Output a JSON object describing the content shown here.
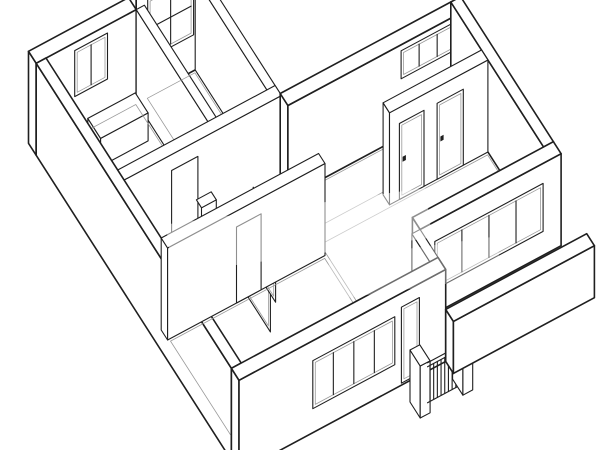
{
  "meta": {
    "description": "Black and white axonometric cutaway line drawing of an apartment floor plan with rooms, windows, interior doors and a balcony with railing",
    "drawing_type": "axonometric-floor-plan"
  },
  "colors": {
    "background": "#ffffff",
    "line": "#1f1f1f",
    "line_light": "#9a9a9a",
    "fill": "#ffffff"
  },
  "drawing": {
    "canvas": {
      "width": 600,
      "height": 450
    },
    "projection": {
      "origin": [
        46,
        150
      ],
      "u_axis": [
        0.82,
        -0.44
      ],
      "v_axis": [
        0.64,
        1.0
      ]
    },
    "elements": [
      {
        "kind": "box",
        "id": "wall-top-center-tall",
        "u1": 110,
        "u2": 192,
        "v1": -12,
        "v2": 0,
        "h": 152,
        "w": "heavy",
        "openings": [
          {
            "type": "window",
            "from": 124,
            "to": 180,
            "sill": 36,
            "head": 96,
            "cols": 2,
            "rows": 2
          }
        ]
      },
      {
        "kind": "box",
        "id": "wall-bath-exterior",
        "u1": -12,
        "u2": 110,
        "v1": -12,
        "v2": 0,
        "h": 92,
        "w": "heavy",
        "openings": [
          {
            "type": "window",
            "from": 35,
            "to": 75,
            "sill": 38,
            "head": 84,
            "cols": 2,
            "rows": 1
          }
        ]
      },
      {
        "kind": "box",
        "id": "wall-bath-divider",
        "u1": 110,
        "u2": 120,
        "v1": 0,
        "v2": 120,
        "h": 92,
        "w": "norm"
      },
      {
        "kind": "box",
        "id": "bathtub",
        "u1": 40,
        "u2": 98,
        "v1": 14,
        "v2": 34,
        "h": 28,
        "w": "norm"
      },
      {
        "kind": "floor",
        "id": "floor-bath",
        "pts": [
          [
            2,
            2
          ],
          [
            108,
            2
          ],
          [
            108,
            110
          ],
          [
            2,
            110
          ]
        ]
      },
      {
        "kind": "box",
        "id": "wall-corridor",
        "u1": 182,
        "u2": 192,
        "v1": 0,
        "v2": 175,
        "h": 92,
        "w": "norm"
      },
      {
        "kind": "floor",
        "id": "floor-hall",
        "pts": [
          [
            122,
            2
          ],
          [
            180,
            2
          ],
          [
            180,
            110
          ],
          [
            122,
            110
          ]
        ]
      },
      {
        "kind": "box",
        "id": "wall-hall-south",
        "u1": 0,
        "u2": 192,
        "v1": 112,
        "v2": 122,
        "h": 92,
        "w": "norm",
        "openings": [
          {
            "type": "doorway",
            "from": 58,
            "to": 90,
            "sill": 0,
            "head": 76
          }
        ]
      },
      {
        "kind": "toilet",
        "id": "toilet",
        "u": 105,
        "v": 140
      },
      {
        "kind": "floor",
        "id": "floor-bedroom",
        "pts": [
          [
            194,
            134
          ],
          [
            398,
            134
          ],
          [
            398,
            166
          ],
          [
            194,
            166
          ]
        ]
      },
      {
        "kind": "box",
        "id": "wall-bedroom-north",
        "u1": 192,
        "u2": 400,
        "v1": 120,
        "v2": 132,
        "h": 92,
        "w": "heavy",
        "openings": [
          {
            "type": "transom",
            "from": 330,
            "to": 396,
            "sill": 58,
            "head": 86,
            "cols": 3,
            "rows": 1
          }
        ]
      },
      {
        "kind": "box",
        "id": "wall-northeast-exterior",
        "u1": 400,
        "u2": 412,
        "v1": 120,
        "v2": 265,
        "h": 92,
        "w": "heavy"
      },
      {
        "kind": "box",
        "id": "wall-bedroom-doors",
        "u1": 280,
        "u2": 400,
        "v1": 168,
        "v2": 178,
        "h": 92,
        "w": "norm",
        "openings": [
          {
            "type": "door",
            "from": 292,
            "to": 322,
            "sill": 0,
            "head": 76
          },
          {
            "type": "door",
            "from": 338,
            "to": 370,
            "sill": 0,
            "head": 76
          }
        ]
      },
      {
        "kind": "floor",
        "id": "floor-living",
        "pts": [
          [
            194,
            180
          ],
          [
            398,
            180
          ],
          [
            398,
            263
          ],
          [
            242,
            263
          ],
          [
            242,
            303
          ],
          [
            194,
            303
          ]
        ]
      },
      {
        "kind": "box",
        "id": "wall-southwest-exterior",
        "u1": -12,
        "u2": 0,
        "v1": 0,
        "v2": 305,
        "h": 92,
        "w": "heavy"
      },
      {
        "kind": "leaf",
        "id": "door-leaf-hall",
        "u": 98,
        "v1": 190,
        "v2": 225,
        "h": 76
      },
      {
        "kind": "leaf",
        "id": "door-leaf-glass",
        "u": 120,
        "v1": 170,
        "v2": 205,
        "h": 80
      },
      {
        "kind": "box",
        "id": "wall-bottomroom-north",
        "u1": 0,
        "u2": 192,
        "v1": 180,
        "v2": 190,
        "h": 92,
        "w": "norm",
        "openings": [
          {
            "type": "doorway",
            "from": 84,
            "to": 114,
            "sill": 0,
            "head": 76
          }
        ]
      },
      {
        "kind": "floor",
        "id": "floor-bottomroom",
        "pts": [
          [
            2,
            192
          ],
          [
            190,
            192
          ],
          [
            190,
            303
          ],
          [
            2,
            303
          ]
        ]
      },
      {
        "kind": "box",
        "id": "wall-living-window",
        "u1": 240,
        "u2": 412,
        "v1": 265,
        "v2": 277,
        "h": 92,
        "w": "heavy",
        "openings": [
          {
            "type": "window",
            "from": 258,
            "to": 390,
            "sill": 24,
            "head": 72,
            "cols": 4,
            "rows": 1
          }
        ]
      },
      {
        "kind": "box",
        "id": "wall-step",
        "u1": 230,
        "u2": 240,
        "v1": 277,
        "v2": 317,
        "h": 92,
        "w": "norm"
      },
      {
        "kind": "box",
        "id": "wall-bottom-window",
        "u1": -12,
        "u2": 240,
        "v1": 305,
        "v2": 317,
        "h": 92,
        "w": "heavy",
        "openings": [
          {
            "type": "window",
            "from": 78,
            "to": 178,
            "sill": 24,
            "head": 72,
            "cols": 4,
            "rows": 1
          },
          {
            "type": "window",
            "from": 186,
            "to": 208,
            "sill": 2,
            "head": 78,
            "cols": 1,
            "rows": 1
          }
        ]
      },
      {
        "kind": "box",
        "id": "balcony-pillar-left",
        "u1": 184,
        "u2": 196,
        "v1": 333,
        "v2": 349,
        "h": 52,
        "w": "norm"
      },
      {
        "kind": "railing",
        "id": "balcony-railing",
        "u1": 196,
        "u2": 238,
        "v": 345,
        "h": 46,
        "bars": 9
      },
      {
        "kind": "box",
        "id": "balcony-pillar-right",
        "u1": 236,
        "u2": 248,
        "v1": 333,
        "v2": 349,
        "h": 52,
        "w": "norm"
      },
      {
        "kind": "box",
        "id": "balcony-parapet",
        "u1": 240,
        "u2": 412,
        "v1": 317,
        "v2": 329,
        "h": 52,
        "w": "heavy"
      },
      {
        "kind": "watermark",
        "id": "watermark-band-1",
        "x": 168,
        "y": 206,
        "wd": 262,
        "ht": 50,
        "angle": -8,
        "opacity": 0.5
      },
      {
        "kind": "watermark",
        "id": "watermark-band-2",
        "x": 330,
        "y": 248,
        "wd": 170,
        "ht": 40,
        "angle": -8,
        "opacity": 0.35
      }
    ]
  }
}
